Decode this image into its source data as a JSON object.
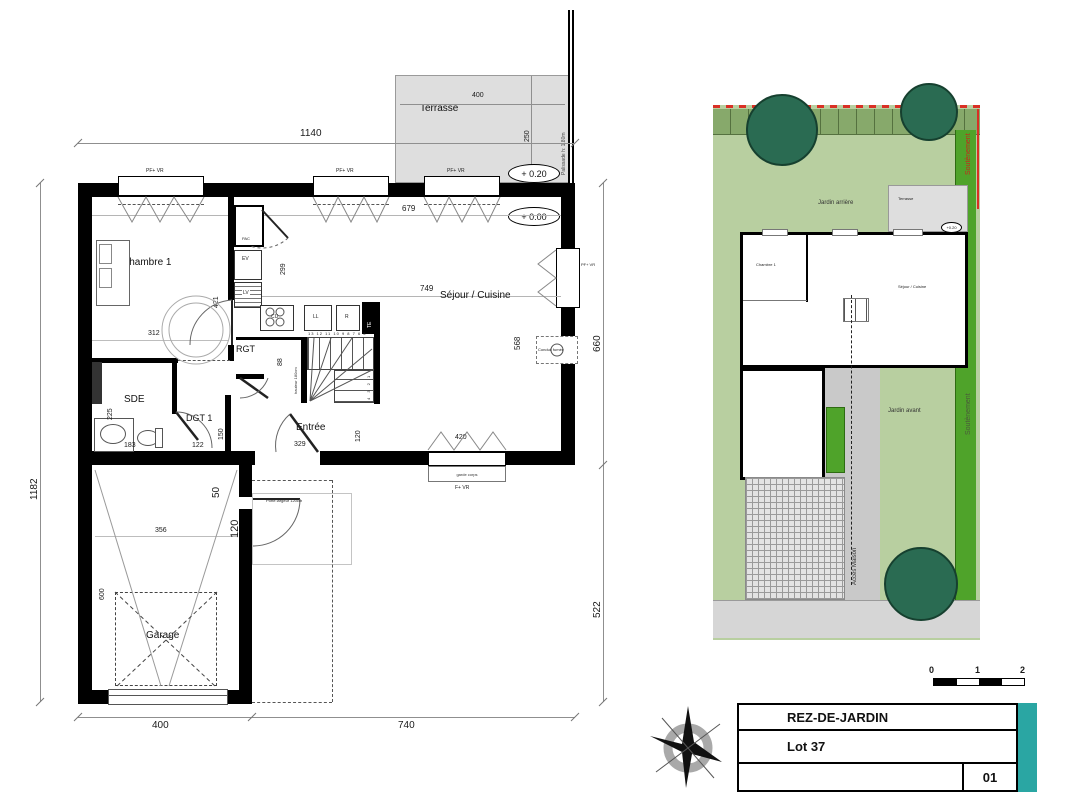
{
  "plan": {
    "terrasse_label": "Terrasse",
    "palissade_label": "Palissade h: 1.80m",
    "level_plus20": "+ 0.20",
    "level_zero": "+ 0.00",
    "window_label": "PF+ VR",
    "window_label_bottom": "F+ VR",
    "garde_corps": "garde corps",
    "conduit_fumee": "Conduit fumée",
    "porte_garage_label": "Porte largeur 120cm",
    "hauteur_stairs": "hauteur 180cm",
    "stair_numbers_top": "13 12 11 10 9 8 7 6 5",
    "stair_numbers_side": "4 3 2 1",
    "rooms": {
      "chambre1": "Chambre 1",
      "sejour": "Séjour / Cuisine",
      "sde": "SDE",
      "dgt1": "DGT 1",
      "rgt": "RGT",
      "entree": "Entrée",
      "garage": "Garage"
    },
    "equipment": {
      "pac": "PAC",
      "ev": "EV",
      "lv": "LV",
      "cu": "CU",
      "ll": "LL",
      "r": "R",
      "te": "TE"
    },
    "dims": {
      "top": "1140",
      "left": "1182",
      "right_upper": "660",
      "right_lower": "522",
      "bottom_left": "400",
      "bottom_right": "740",
      "terrasse_w": "400",
      "terrasse_d": "250",
      "interior_top": "679",
      "sejour_w": "749",
      "sejour_d": "568",
      "kitchen_d": "299",
      "chambre_w": "312",
      "chambre_d": "356",
      "chambre_h": "421",
      "sde_d": "225",
      "sde_w": "183",
      "dgt_w": "122",
      "door_w": "150",
      "entree_w": "329",
      "entree_d": "120",
      "rgt_d": "88",
      "garage_w": "356",
      "garage_d": "600",
      "offset_50": "50",
      "porte_120": "120",
      "baie_w": "420"
    }
  },
  "site": {
    "jardin_arriere": "Jardin arrière",
    "jardin_avant": "Jardin avant",
    "terrasse": "Terrasse",
    "acces_maison": "Accès Maison",
    "soutenement_top": "Soutènement",
    "soutenement_side": "Soutènement",
    "mini": {
      "chambre1": "Chambre 1",
      "sejour": "Séjour / Cuisine",
      "plus20": "+0.20",
      "zero": "+0.00"
    }
  },
  "titleblock": {
    "floor_title": "REZ-DE-JARDIN",
    "lot": "Lot 37",
    "sheet_number": "01",
    "accent": "#2aa6a3"
  },
  "scalebar": {
    "zero": "0",
    "one": "1",
    "two": "2"
  },
  "colors": {
    "garden_light": "#b8cfa0",
    "hedge": "#87a96b",
    "tree": "#2a6b52",
    "planting": "#4fa32a",
    "paving": "#c9c9c9",
    "red_marker": "#d93025",
    "wall": "#000000",
    "terrace_gray": "#dedede"
  }
}
